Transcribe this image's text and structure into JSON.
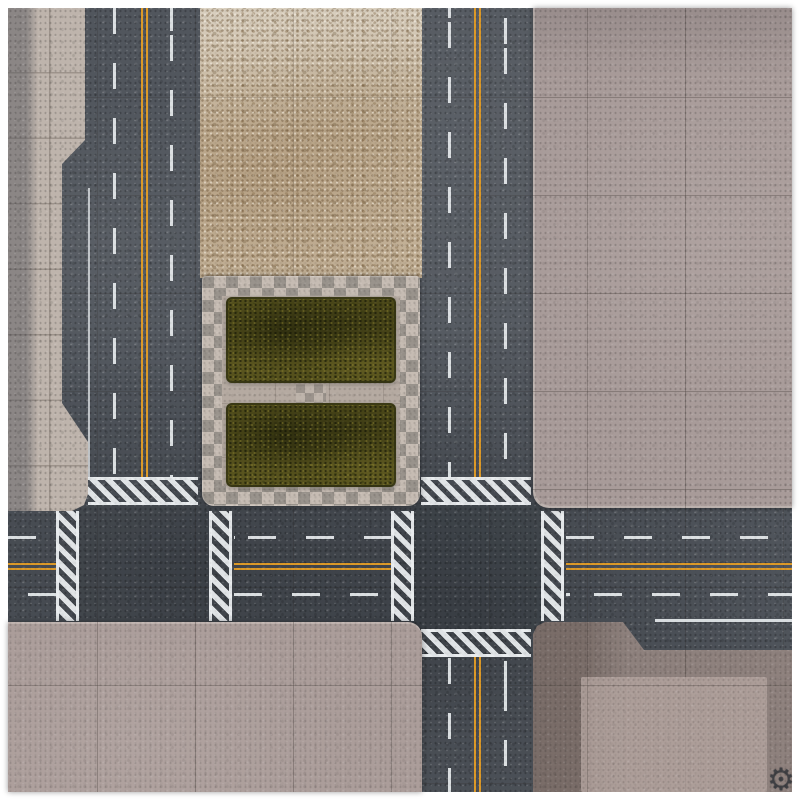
{
  "scene": {
    "kind": "Top-down city streets tabletop gaming mat",
    "logo_glyph": "⚙"
  },
  "palette": {
    "frame": "#ffffff",
    "asphalt": "#51565d",
    "lane_yellow": "#dd9a28",
    "lane_white": "#e8ebed",
    "sidewalk_pale": "#beb4ac",
    "dirt_tan": "#c2b096",
    "plaza_paving": "#b5aaa1",
    "checker_light": "#c6bcb3",
    "checker_dark": "#99938c",
    "concrete_pink": "#a89b99",
    "concrete_dark": "#8e817d",
    "grass_green": "#54501c"
  },
  "features": {
    "vertical_roads": 2,
    "horizontal_roads": 1,
    "crosswalks": 7,
    "grass_patches": 2,
    "plaza_blocks": 1
  }
}
